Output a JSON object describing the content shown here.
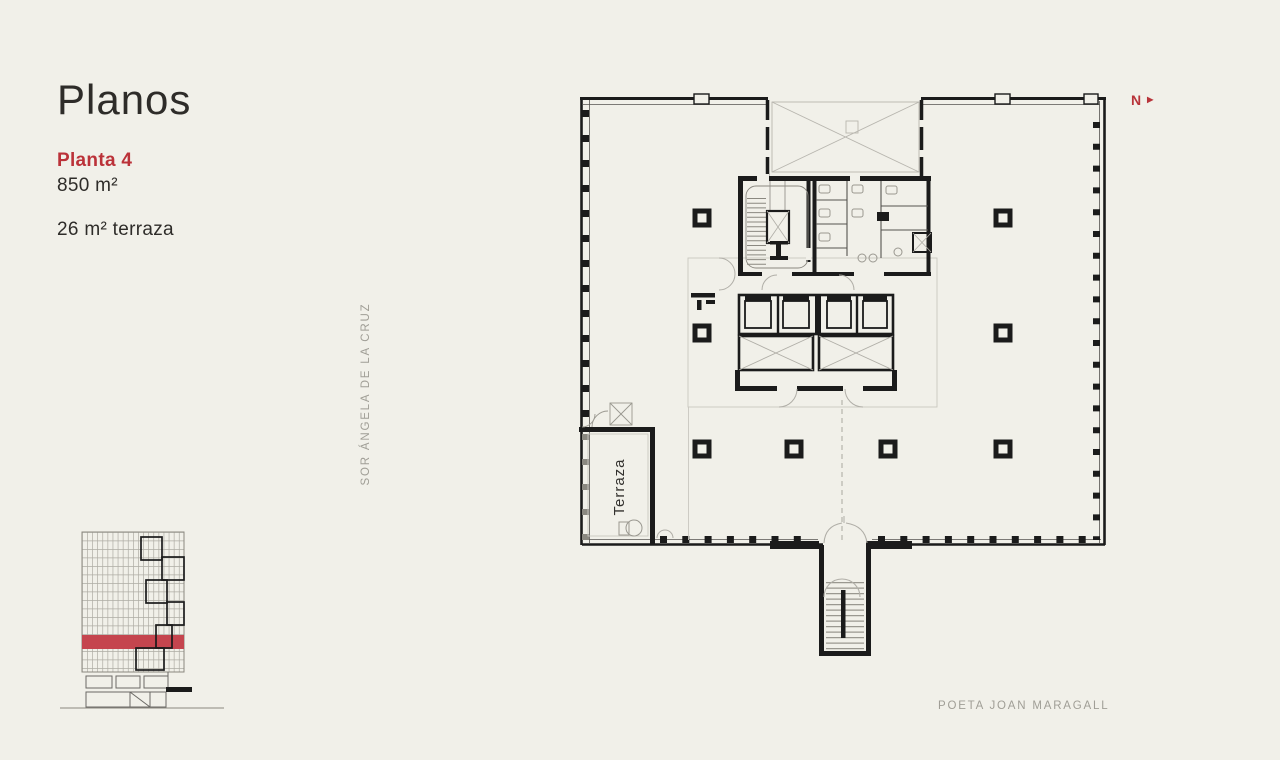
{
  "page": {
    "title": "Planos"
  },
  "floor": {
    "label": "Planta 4",
    "area": "850 m²",
    "terrace_area": "26 m² terraza"
  },
  "streets": {
    "west": "SOR ÁNGELA DE LA CRUZ",
    "south": "POETA JOAN MARAGALL"
  },
  "compass": {
    "north_label": "N"
  },
  "plan": {
    "terrace_room_label": "Terraza"
  },
  "colors": {
    "background": "#f1f0e9",
    "accent": "#bb3239",
    "ink": "#2e2c29",
    "muted": "#a09e96",
    "plan_line": "#1b1b1b"
  }
}
